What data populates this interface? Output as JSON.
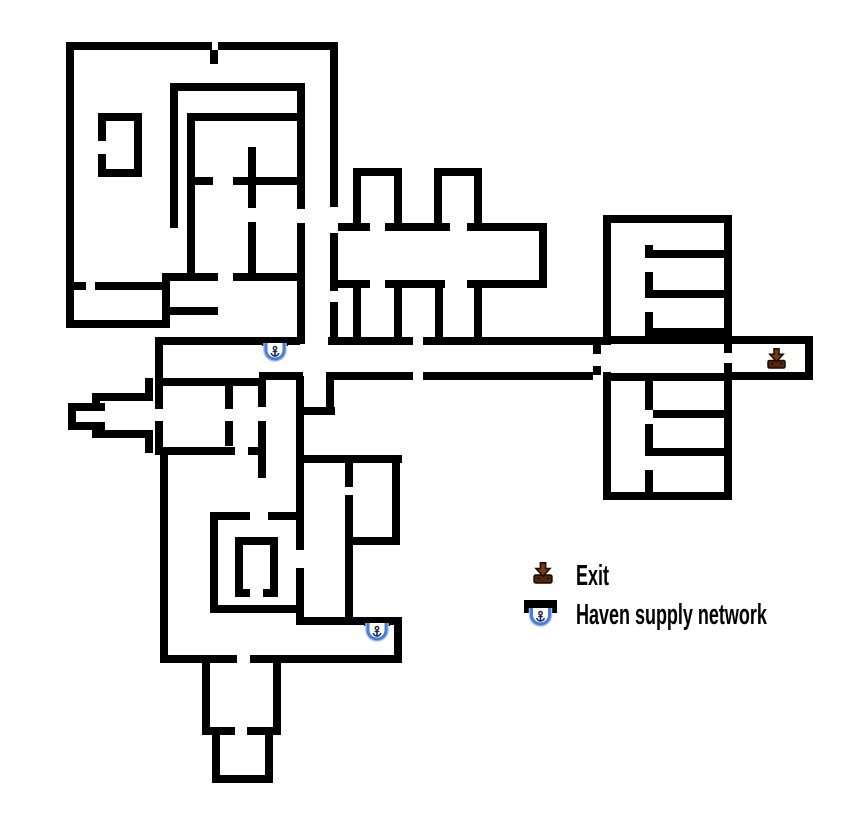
{
  "canvas": {
    "width": 850,
    "height": 820,
    "background": "#ffffff"
  },
  "colors": {
    "wall": "#000000",
    "exit_fill": "#7a3a16",
    "exit_base": "#52270d",
    "exit_outline": "#190c02",
    "supply_blue": "#4a7ed9",
    "supply_blue_light": "#a9c2f2",
    "supply_glyph": "#1c2b4e",
    "text": "#000000"
  },
  "map": {
    "wall_thickness": 8,
    "walls": [
      [
        66,
        42,
        146,
        8
      ],
      [
        218,
        42,
        120,
        8
      ],
      [
        210,
        50,
        8,
        14
      ],
      [
        66,
        42,
        8,
        286
      ],
      [
        66,
        320,
        101,
        8
      ],
      [
        330,
        42,
        8,
        165
      ],
      [
        330,
        233,
        8,
        58
      ],
      [
        330,
        302,
        8,
        43
      ],
      [
        98,
        113,
        44,
        8
      ],
      [
        134,
        113,
        8,
        64
      ],
      [
        98,
        169,
        44,
        8
      ],
      [
        98,
        113,
        8,
        28
      ],
      [
        98,
        154,
        8,
        23
      ],
      [
        170,
        83,
        8,
        145
      ],
      [
        170,
        83,
        135,
        8
      ],
      [
        297,
        83,
        8,
        126
      ],
      [
        297,
        223,
        8,
        121
      ],
      [
        187,
        113,
        118,
        8
      ],
      [
        187,
        113,
        8,
        161
      ],
      [
        193,
        177,
        20,
        8
      ],
      [
        233,
        177,
        72,
        8
      ],
      [
        248,
        147,
        8,
        61
      ],
      [
        248,
        222,
        8,
        52
      ],
      [
        163,
        273,
        55,
        8
      ],
      [
        233,
        273,
        64,
        8
      ],
      [
        162,
        273,
        8,
        55
      ],
      [
        163,
        307,
        55,
        8
      ],
      [
        74,
        282,
        12,
        8
      ],
      [
        95,
        282,
        68,
        8
      ],
      [
        353,
        168,
        49,
        8
      ],
      [
        353,
        168,
        8,
        60
      ],
      [
        394,
        168,
        8,
        60
      ],
      [
        434,
        168,
        48,
        8
      ],
      [
        434,
        168,
        8,
        60
      ],
      [
        474,
        168,
        8,
        60
      ],
      [
        338,
        223,
        32,
        8
      ],
      [
        385,
        223,
        65,
        8
      ],
      [
        467,
        223,
        80,
        8
      ],
      [
        539,
        223,
        8,
        65
      ],
      [
        338,
        280,
        32,
        8
      ],
      [
        385,
        280,
        60,
        8
      ],
      [
        467,
        280,
        80,
        8
      ],
      [
        353,
        288,
        8,
        50
      ],
      [
        394,
        288,
        8,
        50
      ],
      [
        435,
        288,
        8,
        50
      ],
      [
        474,
        288,
        8,
        50
      ],
      [
        157,
        337,
        143,
        8
      ],
      [
        328,
        337,
        85,
        8
      ],
      [
        423,
        337,
        180,
        8
      ],
      [
        155,
        337,
        8,
        49
      ],
      [
        259,
        372,
        44,
        8
      ],
      [
        326,
        372,
        87,
        8
      ],
      [
        423,
        372,
        170,
        8
      ],
      [
        593,
        345,
        8,
        9
      ],
      [
        593,
        366,
        8,
        9
      ],
      [
        603,
        215,
        129,
        8
      ],
      [
        603,
        215,
        8,
        130
      ],
      [
        603,
        372,
        8,
        128
      ],
      [
        724,
        215,
        8,
        138
      ],
      [
        724,
        363,
        8,
        137
      ],
      [
        603,
        492,
        129,
        8
      ],
      [
        611,
        336,
        113,
        8
      ],
      [
        611,
        373,
        113,
        8
      ],
      [
        653,
        250,
        79,
        8
      ],
      [
        653,
        290,
        79,
        8
      ],
      [
        653,
        328,
        79,
        8
      ],
      [
        653,
        410,
        79,
        8
      ],
      [
        653,
        448,
        79,
        8
      ],
      [
        645,
        245,
        8,
        13
      ],
      [
        645,
        272,
        8,
        26
      ],
      [
        645,
        312,
        8,
        32
      ],
      [
        645,
        373,
        8,
        37
      ],
      [
        645,
        424,
        8,
        32
      ],
      [
        645,
        470,
        8,
        30
      ],
      [
        732,
        336,
        81,
        8
      ],
      [
        732,
        372,
        73,
        8
      ],
      [
        805,
        336,
        8,
        44
      ],
      [
        296,
        376,
        8,
        174
      ],
      [
        296,
        568,
        8,
        57
      ],
      [
        326,
        380,
        8,
        35
      ],
      [
        304,
        407,
        31,
        8
      ],
      [
        258,
        378,
        8,
        29
      ],
      [
        258,
        421,
        8,
        57
      ],
      [
        225,
        386,
        8,
        23
      ],
      [
        225,
        421,
        8,
        25
      ],
      [
        68,
        403,
        37,
        8
      ],
      [
        68,
        422,
        37,
        8
      ],
      [
        68,
        403,
        8,
        27
      ],
      [
        92,
        393,
        8,
        17
      ],
      [
        92,
        422,
        8,
        16
      ],
      [
        92,
        393,
        61,
        8
      ],
      [
        92,
        430,
        61,
        8
      ],
      [
        145,
        378,
        8,
        23
      ],
      [
        145,
        430,
        8,
        23
      ],
      [
        155,
        378,
        107,
        8
      ],
      [
        155,
        386,
        8,
        23
      ],
      [
        155,
        421,
        8,
        26
      ],
      [
        155,
        447,
        80,
        8
      ],
      [
        248,
        447,
        10,
        8
      ],
      [
        160,
        455,
        8,
        202
      ],
      [
        160,
        655,
        77,
        8
      ],
      [
        250,
        655,
        152,
        8
      ],
      [
        394,
        617,
        8,
        40
      ],
      [
        303,
        617,
        99,
        8
      ],
      [
        210,
        512,
        40,
        8
      ],
      [
        268,
        512,
        36,
        8
      ],
      [
        210,
        520,
        8,
        93
      ],
      [
        210,
        605,
        93,
        8
      ],
      [
        235,
        537,
        43,
        8
      ],
      [
        235,
        537,
        8,
        60
      ],
      [
        270,
        537,
        8,
        60
      ],
      [
        235,
        589,
        15,
        8
      ],
      [
        263,
        589,
        15,
        8
      ],
      [
        303,
        455,
        99,
        8
      ],
      [
        345,
        463,
        8,
        24
      ],
      [
        345,
        495,
        8,
        122
      ],
      [
        392,
        458,
        8,
        82
      ],
      [
        353,
        537,
        47,
        8
      ],
      [
        202,
        663,
        8,
        72
      ],
      [
        273,
        663,
        8,
        72
      ],
      [
        202,
        727,
        33,
        8
      ],
      [
        247,
        727,
        34,
        8
      ],
      [
        212,
        735,
        8,
        48
      ],
      [
        265,
        735,
        8,
        48
      ],
      [
        212,
        775,
        61,
        8
      ]
    ],
    "markers": {
      "supply_points": [
        {
          "x": 262,
          "y": 340
        },
        {
          "x": 364,
          "y": 620
        }
      ],
      "exits": [
        {
          "x": 767,
          "y": 348
        }
      ]
    }
  },
  "legend": {
    "items": [
      {
        "id": "exit",
        "label": "Exit"
      },
      {
        "id": "supply",
        "label": "Haven supply network"
      }
    ]
  }
}
